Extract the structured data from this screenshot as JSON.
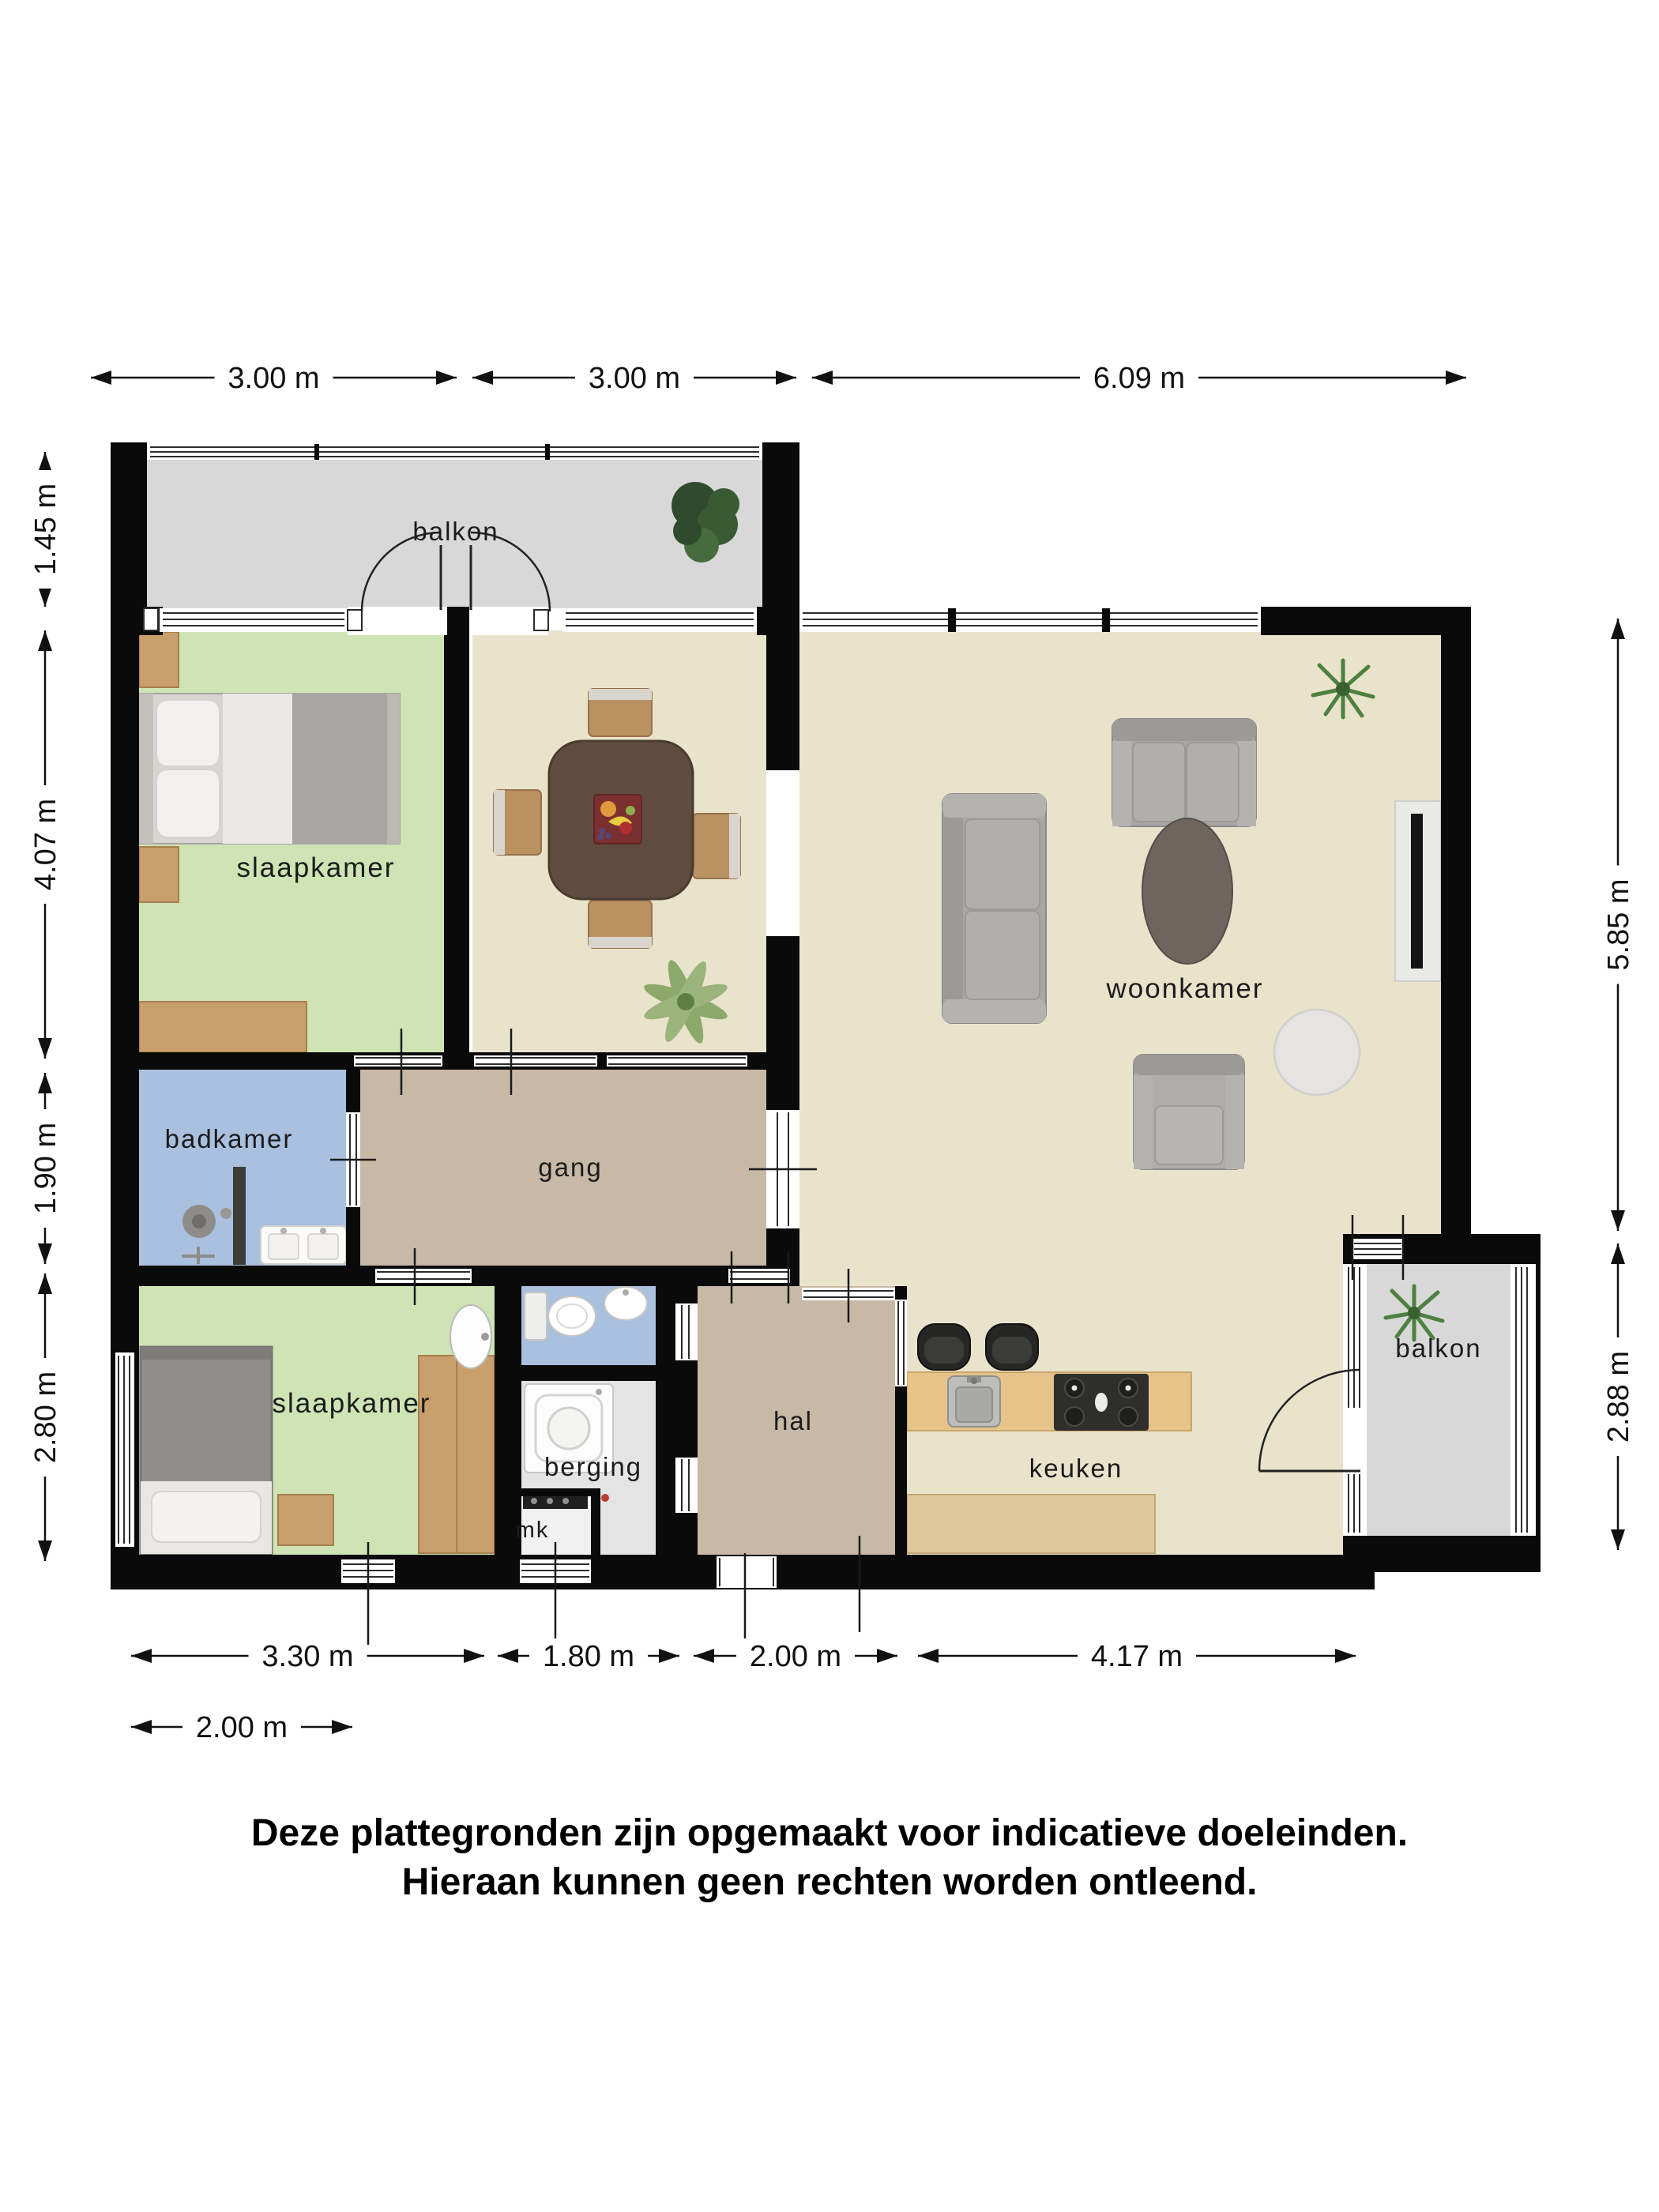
{
  "floorplan": {
    "title": "apartment floor plan",
    "rooms": {
      "balcony_top": {
        "label": "balkon"
      },
      "bedroom_top": {
        "label": "slaapkamer"
      },
      "living": {
        "label": "woonkamer"
      },
      "bathroom": {
        "label": "badkamer"
      },
      "corridor": {
        "label": "gang"
      },
      "bedroom_bottom": {
        "label": "slaapkamer"
      },
      "storage": {
        "label": "berging"
      },
      "meter": {
        "label": "mk"
      },
      "hall": {
        "label": "hal"
      },
      "kitchen": {
        "label": "keuken"
      },
      "balcony_bottom": {
        "label": "balkon"
      }
    },
    "dimensions": {
      "top": [
        "3.00 m",
        "3.00 m",
        "6.09 m"
      ],
      "left": [
        "1.45 m",
        "4.07 m",
        "1.90 m",
        "2.80 m"
      ],
      "right": [
        "5.85 m",
        "2.88 m"
      ],
      "bottom": [
        "3.30 m",
        "1.80 m",
        "2.00 m",
        "4.17 m"
      ],
      "bottom_offset": [
        "2.00 m"
      ]
    },
    "disclaimer": [
      "Deze plattegronden zijn opgemaakt voor indicatieve doeleinden.",
      "Hieraan kunnen geen rechten worden ontleend."
    ],
    "colors": {
      "wall": "#0a0a0a",
      "floor_living": "#EAE3CC",
      "floor_bedroom": "#CFE4B4",
      "floor_bath": "#A9C0DF",
      "floor_corridor": "#C8B8A6",
      "floor_balcony": "#D8D8D8",
      "floor_storage": "#E4E4E4",
      "floor_meter": "#F1F1F1",
      "wood": "#C9A06C",
      "label_text": "#1b1b1b"
    }
  }
}
